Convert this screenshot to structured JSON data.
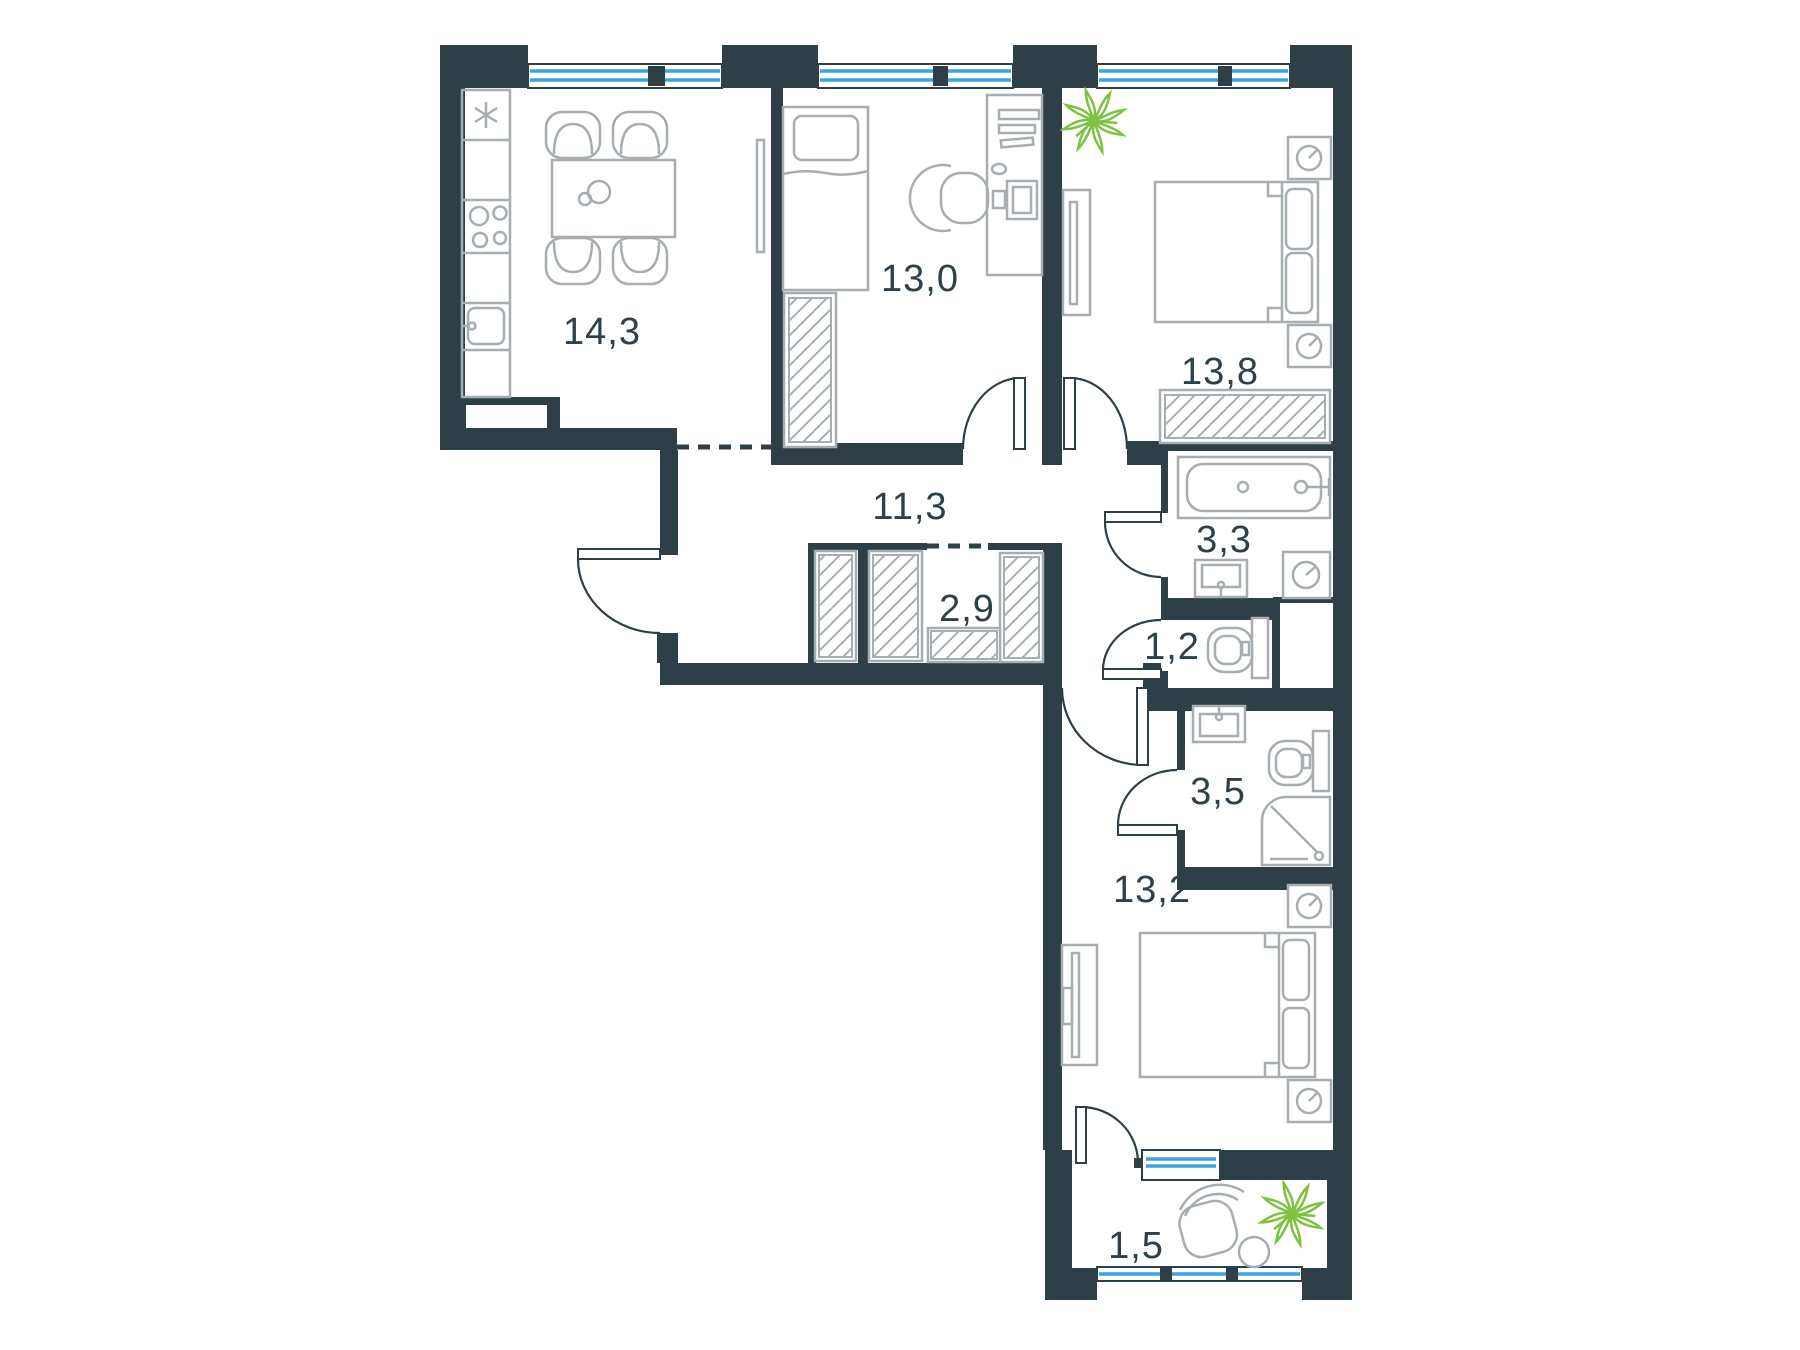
{
  "page": {
    "background": "#ffffff"
  },
  "floor_plan": {
    "kind": "apartment-floor-plan",
    "colors": {
      "wall": "#2e3f48",
      "furniture_line": "#a7aeb2",
      "window_glass": "#3da2e0",
      "plant": "#7fc241",
      "label_text": "#2e4049"
    },
    "rooms": [
      {
        "id": "kitchen-living-room",
        "area": "14,3"
      },
      {
        "id": "bedroom-top",
        "area": "13,0"
      },
      {
        "id": "bedroom-right",
        "area": "13,8"
      },
      {
        "id": "hallway",
        "area": "11,3"
      },
      {
        "id": "wardrobe-closet",
        "area": "2,9"
      },
      {
        "id": "bathroom",
        "area": "3,3"
      },
      {
        "id": "wc",
        "area": "1,2"
      },
      {
        "id": "shower-bathroom",
        "area": "3,5"
      },
      {
        "id": "bedroom-bottom",
        "area": "13,2"
      },
      {
        "id": "balcony",
        "area": "1,5"
      }
    ]
  }
}
